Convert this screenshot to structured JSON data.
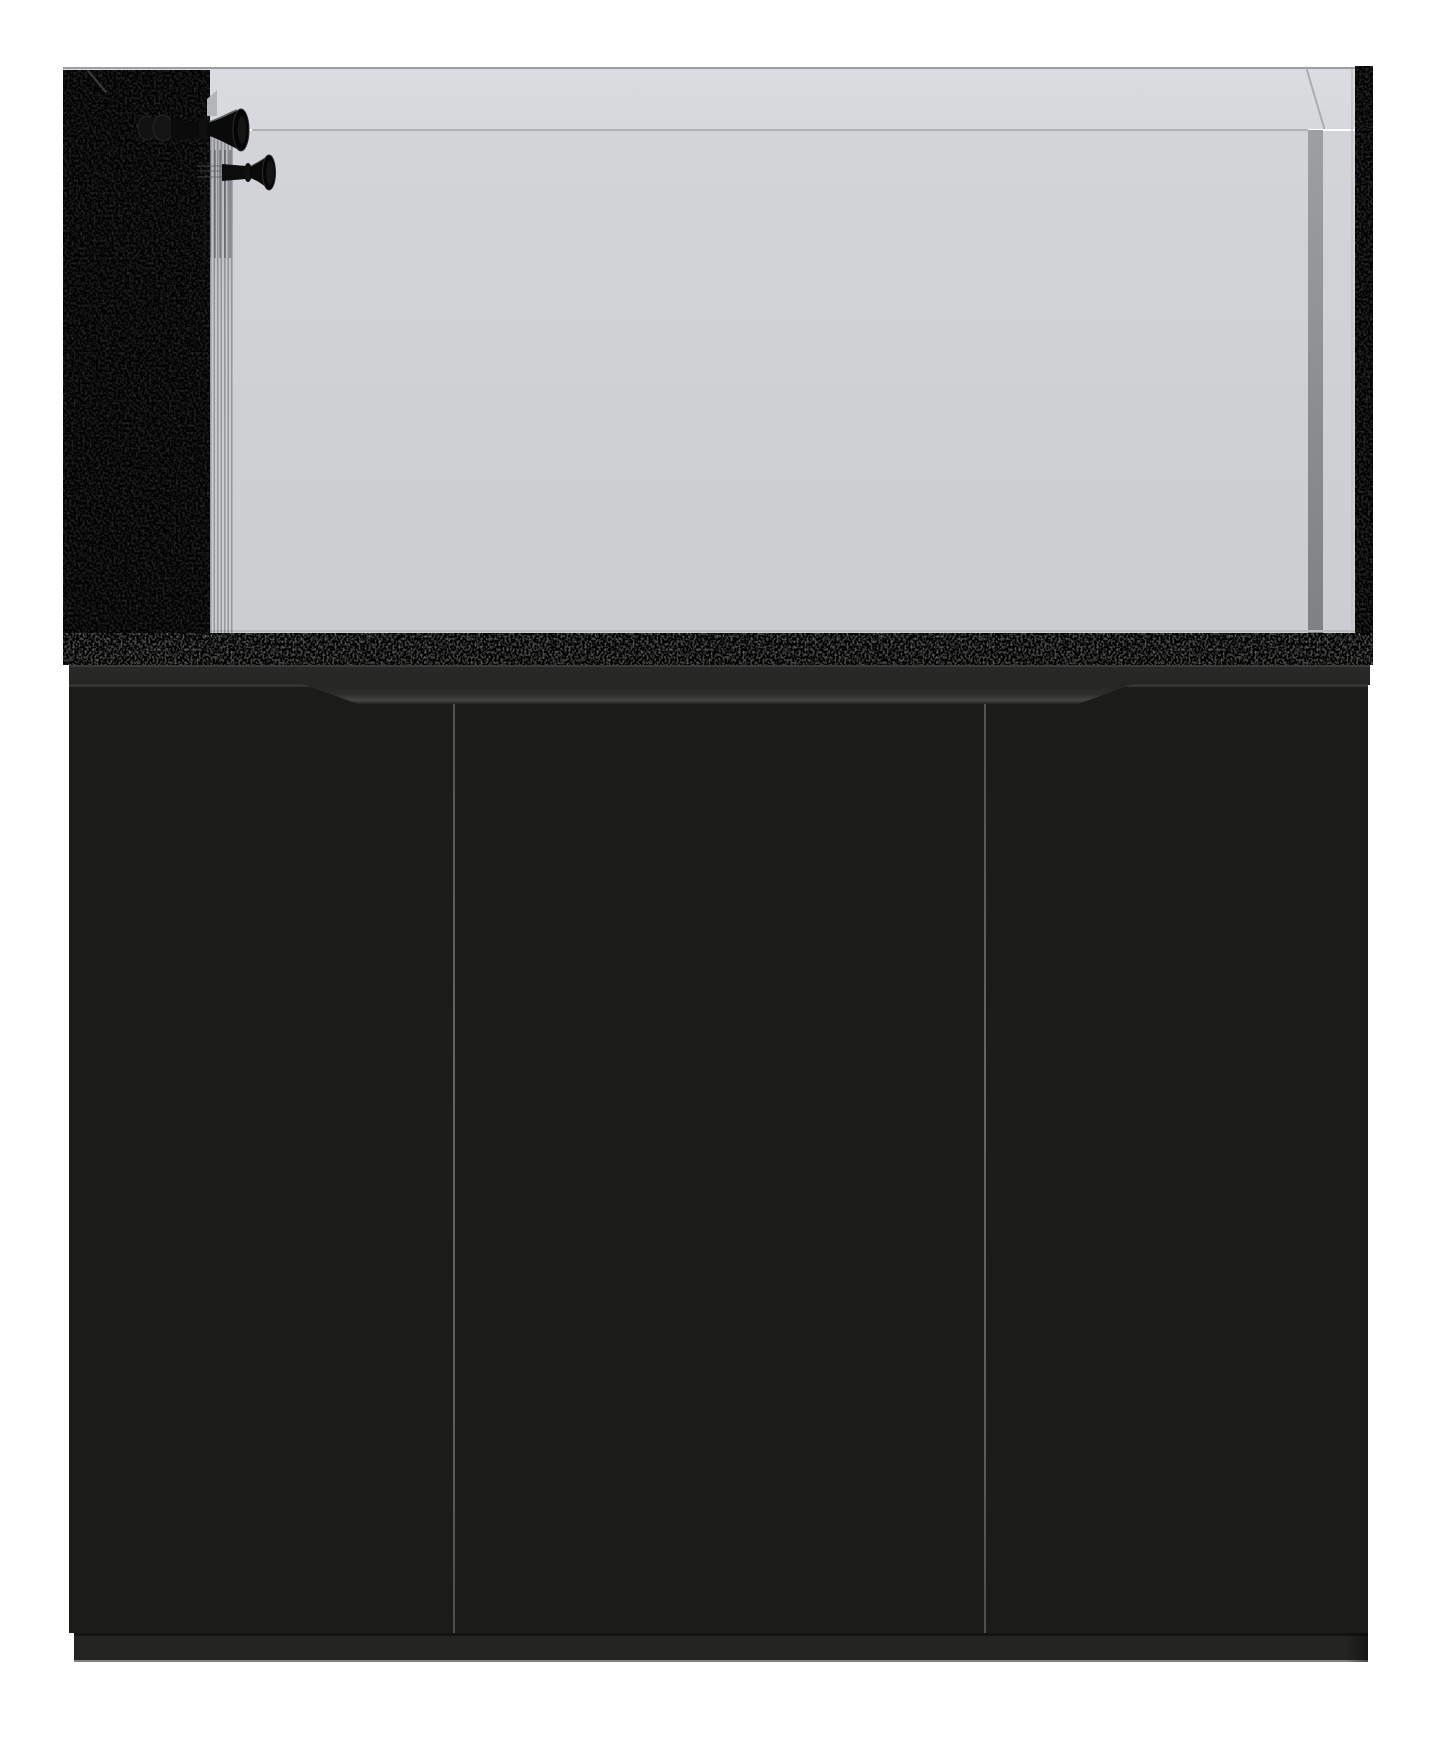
{
  "image": {
    "kind": "product-render",
    "subject": "Rimless glass aquarium with internal black overflow box and two adjustable return nozzles, sitting on a black three-door cabinet stand",
    "background_color": "#ffffff",
    "text_visible": "none"
  },
  "palette": {
    "background": "#ffffff",
    "glass_above_water": "#d7d9dc",
    "water": "#cfd1d5",
    "rim_line": "#9b9da0",
    "waterline": "#a7a9ac",
    "glass_corner_edge": "#8b8d90",
    "trim_black": "#060606",
    "overflow_black": "#050505",
    "speckle_gray": "#6f6f6f",
    "nozzle_black": "#0b0b0b",
    "stand_rail": "#282826",
    "door_face": "#1b1b1a",
    "door_seam": "#4d4d4b",
    "handle_recess_highlight": "#454541",
    "plinth": "#242422",
    "plinth_bottom_edge": "#82827f"
  },
  "tank": {
    "label": "display tank",
    "parts": {
      "top_rim": "glass top rim",
      "waterline": "waterline",
      "overflow_box": "internal overflow box (left)",
      "return_nozzle_upper": "adjustable return nozzle, upper",
      "return_nozzle_lower": "adjustable return nozzle, lower",
      "flow_streaks": "water flow streaks beside overflow",
      "beveled_corner": "beveled glass corner, top right",
      "side_trim_right": "black side trim, right",
      "bottom_trim": "textured black bottom trim"
    }
  },
  "stand": {
    "label": "cabinet stand",
    "door_count": 3,
    "parts": {
      "top_rail": "stand top rail",
      "handle_recess": "routed finger-pull recess",
      "door_left": "left cabinet door",
      "door_center": "center cabinet door",
      "door_right": "right cabinet door",
      "seam_left": "door seam, left",
      "seam_right": "door seam, right",
      "plinth": "base plinth"
    }
  }
}
